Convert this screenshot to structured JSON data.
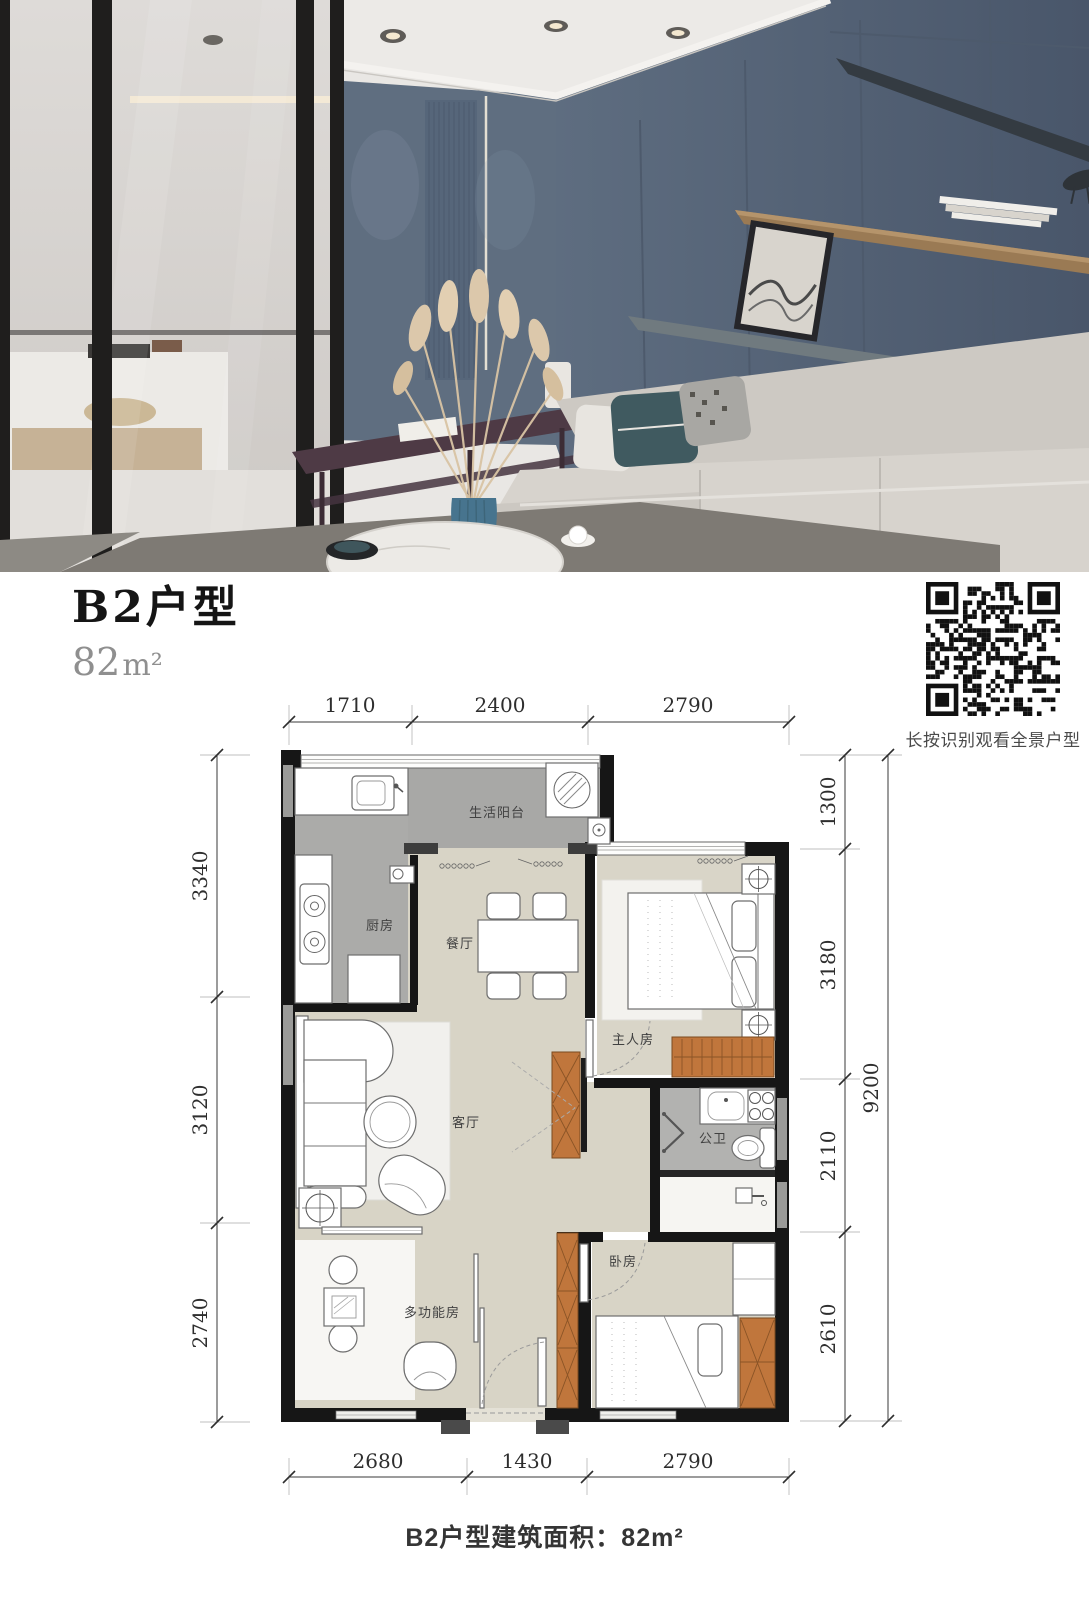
{
  "header": {
    "title": "B2户型",
    "area_value": "82",
    "area_unit": "m²"
  },
  "qr": {
    "caption": "长按识别观看全景户型"
  },
  "floorplan": {
    "dims_top": [
      "1710",
      "2400",
      "2790"
    ],
    "dims_bottom": [
      "2680",
      "1430",
      "2790"
    ],
    "dims_left": [
      "3340",
      "3120",
      "2740"
    ],
    "dims_right": [
      "1300",
      "3180",
      "2110",
      "2610"
    ],
    "dim_right_total": "9200",
    "rooms": {
      "balcony": "生活阳台",
      "kitchen": "厨房",
      "dining": "餐厅",
      "master": "主人房",
      "living": "客厅",
      "bathroom": "公卫",
      "bedroom": "卧房",
      "multi": "多功能房"
    }
  },
  "footer": {
    "caption": "B2户型建筑面积：82m²"
  }
}
